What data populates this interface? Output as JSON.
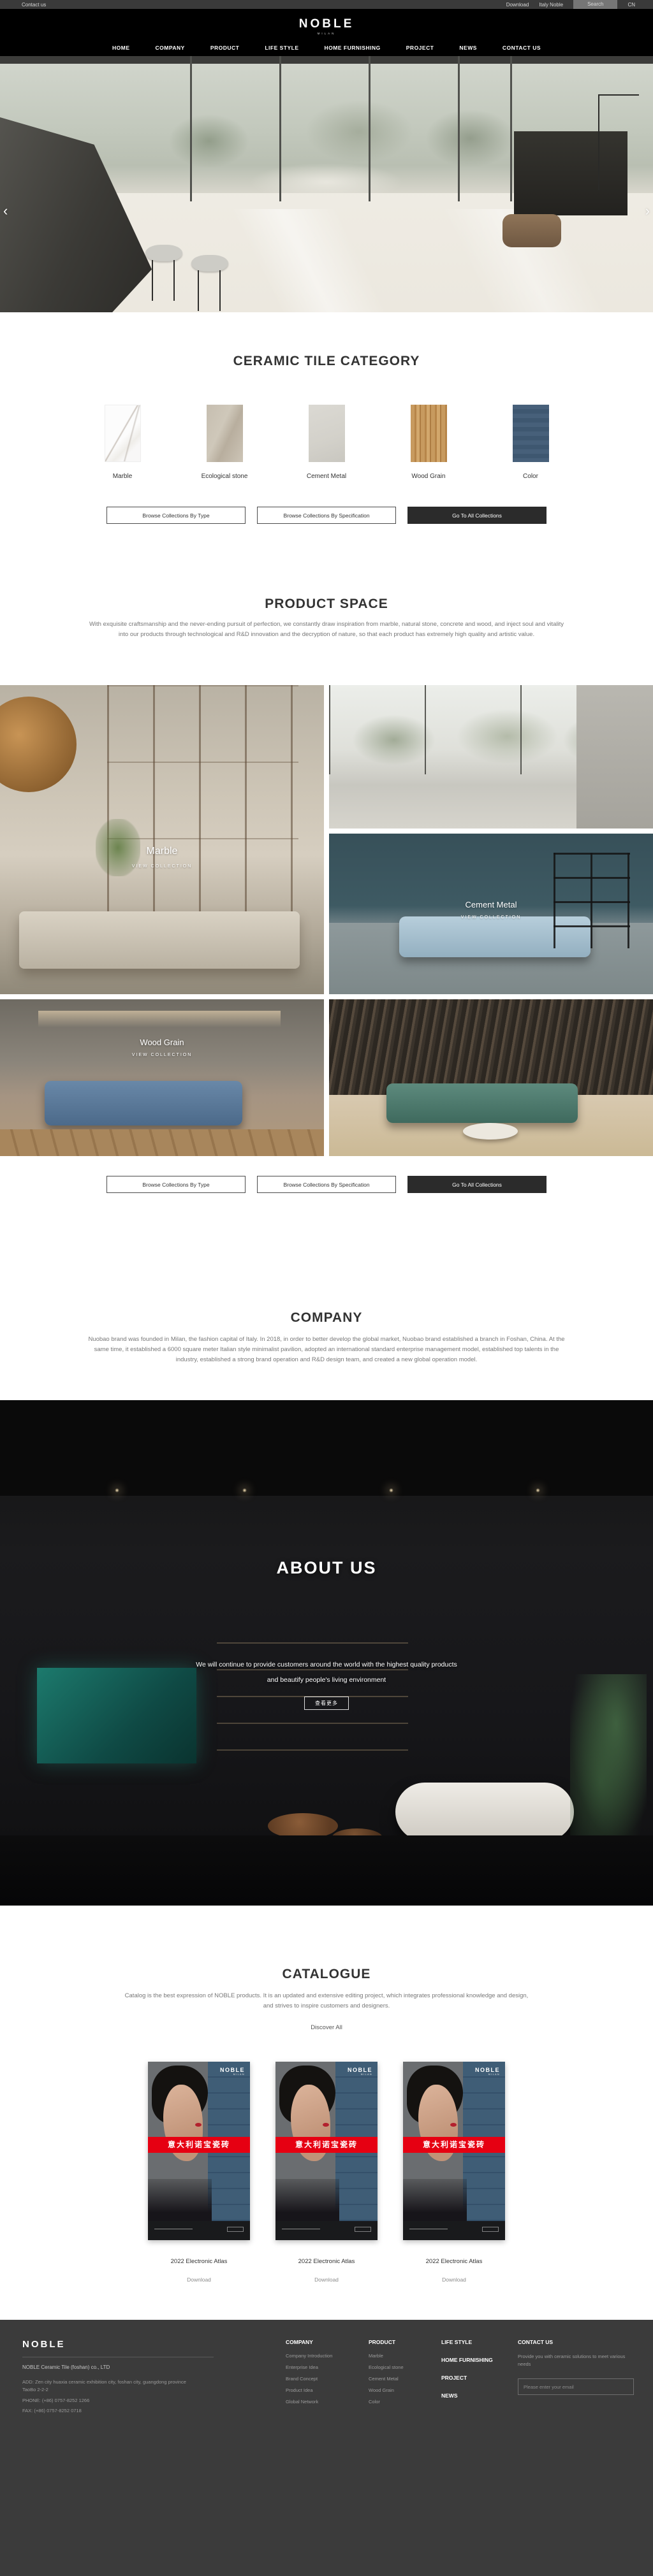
{
  "topbar": {
    "contact": "Contact us",
    "download": "Download",
    "italy": "Italy Noble",
    "search": "Search",
    "lang": "CN"
  },
  "header": {
    "logo": "NOBLE",
    "logo_sub": "MILAN"
  },
  "nav": {
    "items": [
      "HOME",
      "COMPANY",
      "PRODUCT",
      "LIFE STYLE",
      "HOME FURNISHING",
      "PROJECT",
      "NEWS",
      "CONTACT US"
    ]
  },
  "hero": {
    "prev": "‹",
    "next": "›",
    "slides": 4,
    "active_slide": 4
  },
  "category": {
    "title": "CERAMIC TILE CATEGORY",
    "items": [
      {
        "name": "Marble"
      },
      {
        "name": "Ecological stone"
      },
      {
        "name": "Cement Metal"
      },
      {
        "name": "Wood Grain"
      },
      {
        "name": "Color"
      }
    ],
    "btn_type": "Browse Collections By Type",
    "btn_spec": "Browse Collections By Specification",
    "btn_all": "Go To All Collections"
  },
  "product_space": {
    "title": "PRODUCT SPACE",
    "paragraph": "With exquisite craftsmanship and the never-ending pursuit of perfection, we constantly draw inspiration from marble, natural stone, concrete and wood, and inject soul and vitality into our products through technological and R&D innovation and the decryption of nature, so that each product has extremely high quality and artistic value.",
    "view_collection": "VIEW COLLECTION",
    "overlay_marble": "Marble",
    "overlay_cement": "Cement Metal",
    "overlay_wood": "Wood Grain"
  },
  "company": {
    "title": "COMPANY",
    "paragraph": "Nuobao brand was founded in Milan, the fashion capital of Italy. In 2018, in order to better develop the global market, Nuobao brand established a branch in Foshan, China. At the same time, it established a 6000 square meter Italian style minimalist pavilion, adopted an international standard enterprise management model, established top talents in the industry, established a strong brand operation and R&D design team, and created a new global operation model."
  },
  "about": {
    "title": "ABOUT US",
    "line1": "We will continue to provide customers around the world with the highest quality products",
    "line2": "and beautify people's living environment",
    "more": "查看更多"
  },
  "catalogue": {
    "title": "CATALOGUE",
    "paragraph": "Catalog is the best expression of NOBLE products. It is an updated and extensive editing project, which integrates professional knowledge and design, and strives to inspire customers and designers.",
    "discover": "Discover All",
    "cover_brand": "NOBLE",
    "cover_brand_sub": "MILAN",
    "cover_band": "意大利诺宝瓷砖",
    "items": [
      {
        "label": "2022 Electronic Atlas",
        "download": "Download"
      },
      {
        "label": "2022 Electronic Atlas",
        "download": "Download"
      },
      {
        "label": "2022 Electronic Atlas",
        "download": "Download"
      }
    ]
  },
  "footer": {
    "brand": "NOBLE",
    "company_name": "NOBLE Ceramic Tile (foshan) co., LTD",
    "address": "ADD:  Zen city huaxia ceramic exhibition city, foshan city, guangdong province TaoBo 2-2-2",
    "phone": "PHONE:   (+86) 0757-8252 1266",
    "fax": "FAX:   (+86) 0757-8252 0718",
    "col_company": {
      "title": "COMPANY",
      "items": [
        "Company Introduction",
        "Enterprise Idea",
        "Brand Concept",
        "Product Idea",
        "Global Network"
      ]
    },
    "col_product": {
      "title": "PRODUCT",
      "items": [
        "Marble",
        "Ecological stone",
        "Cement Metal",
        "Wood Grain",
        "Color"
      ]
    },
    "col_links": [
      "LIFE STYLE",
      "HOME FURNISHING",
      "PROJECT",
      "NEWS"
    ],
    "contact": {
      "title": "CONTACT US",
      "text": "Provide you with ceramic solutions to meet various needs",
      "placeholder": "Please enter your email"
    }
  },
  "colors": {
    "accent_red": "#e60012",
    "dark_button": "#2b2b2b",
    "footer_bg": "#3b3b3b"
  }
}
